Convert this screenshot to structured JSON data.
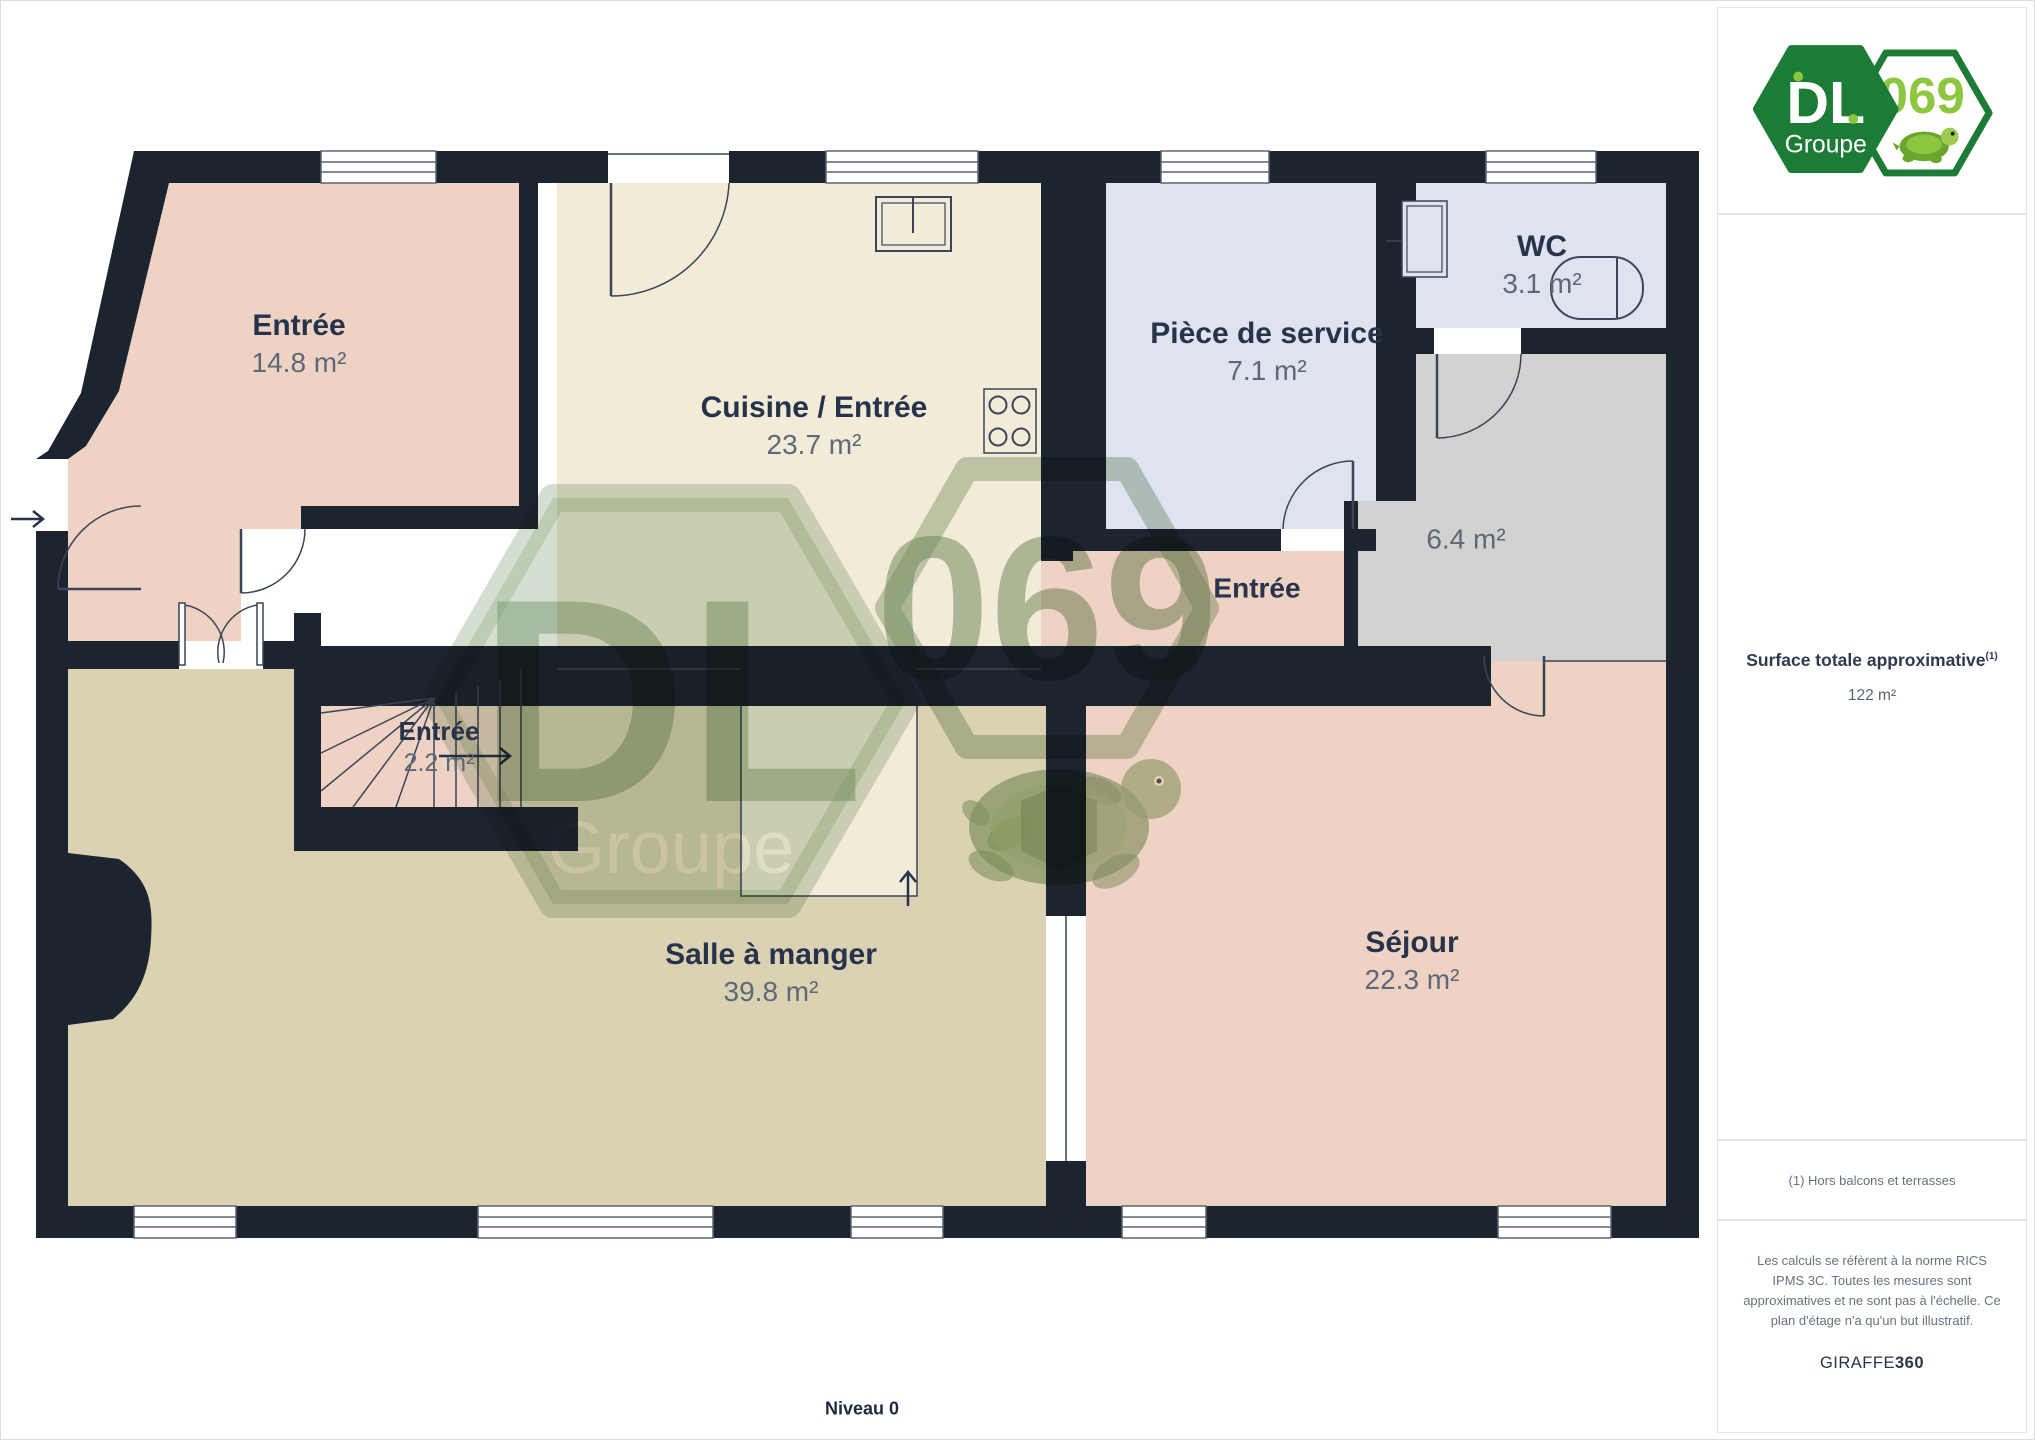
{
  "plan": {
    "level_label": "Niveau 0",
    "rooms": [
      {
        "name": "Entrée",
        "area": "14.8 m²"
      },
      {
        "name": "Cuisine / Entrée",
        "area": "23.7 m²"
      },
      {
        "name": "Pièce de service",
        "area": "7.1 m²"
      },
      {
        "name": "WC",
        "area": "3.1 m²"
      },
      {
        "name": "",
        "area": "6.4 m²"
      },
      {
        "name": "Entrée",
        "area": ""
      },
      {
        "name": "Entrée",
        "area": "2.2 m²"
      },
      {
        "name": "Salle à manger",
        "area": "39.8 m²"
      },
      {
        "name": "Séjour",
        "area": "22.3 m²"
      }
    ]
  },
  "logo": {
    "dl": "DL",
    "groupe": "Groupe",
    "number": "069"
  },
  "sidebar": {
    "surface_label": "Surface totale approximative",
    "surface_sup": "(1)",
    "surface_value": "122 m²",
    "note": "(1) Hors balcons et terrasses",
    "disclaimer": "Les calculs se réfèrent à la norme RICS IPMS 3C. Toutes les mesures sont approximatives et ne sont pas à l'échelle. Ce plan d'étage n'a qu'un but illustratif.",
    "brand": "GIRAFFE",
    "brand_suffix": "360"
  },
  "colors": {
    "wall": "#1c2430",
    "floor_pink": "#eed3c4",
    "floor_cream": "#f2ebd8",
    "floor_lavender": "#dfe3ef",
    "floor_gray": "#d3d2d0",
    "floor_tan": "#dbd1b3",
    "thin_line": "#3c4557",
    "label_navy": "#26334b",
    "label_gray": "#5e6878",
    "logo_green": "#1c7c35",
    "logo_lime": "#8dc63f",
    "watermark_green": "#96b08c"
  }
}
